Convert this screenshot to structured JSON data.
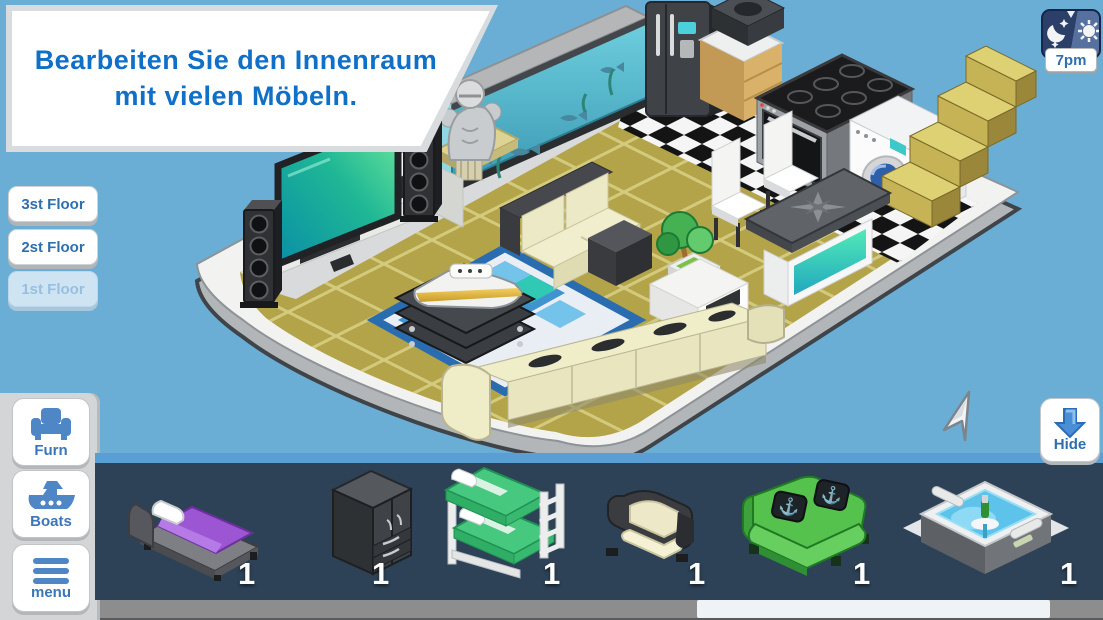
{
  "banner": {
    "text": "Bearbeiten Sie den Innenraum mit vielen Möbeln."
  },
  "floor_buttons": [
    {
      "label": "3st Floor",
      "active": true
    },
    {
      "label": "2st Floor",
      "active": true
    },
    {
      "label": "1st Floor",
      "active": false
    }
  ],
  "time_widget": {
    "label": "7pm",
    "icon": "day-night-cycle-icon"
  },
  "sidebar_buttons": [
    {
      "label": "Furn",
      "icon": "armchair-icon"
    },
    {
      "label": "Boats",
      "icon": "boat-icon"
    },
    {
      "label": "menu",
      "icon": "hamburger-menu-icon"
    }
  ],
  "hide_button": {
    "label": "Hide",
    "icon": "arrow-down-icon"
  },
  "inventory": {
    "items": [
      {
        "name": "single-bed-purple",
        "count": "1"
      },
      {
        "name": "wardrobe-black",
        "count": "1"
      },
      {
        "name": "bunk-bed-green",
        "count": "1"
      },
      {
        "name": "armchair-black-cream",
        "count": "1"
      },
      {
        "name": "sofa-green-anchor-pillows",
        "count": "1"
      },
      {
        "name": "hot-tub",
        "count": "1"
      }
    ]
  },
  "scene": {
    "objects": [
      "tv",
      "tv-stand",
      "tower-speakers",
      "statue-bust",
      "aquarium",
      "fridge",
      "kitchen-sink-counter",
      "stove-oven",
      "washing-machine",
      "stairs",
      "cream-sofa",
      "long-cream-couch",
      "dining-chairs",
      "sideboard-table-compass",
      "side-table-with-plant",
      "yacht-model-on-stack",
      "blue-rug"
    ]
  },
  "colors": {
    "sky": "#6aaed6",
    "accent_blue": "#1070c8",
    "button_text_blue": "#2e6fae",
    "panel_dark": "#2d4257",
    "panel_edge_blue": "#5b9ed3",
    "deck_white": "#f2f3f1",
    "floor_khaki": "#b3a349",
    "grout": "#d4ca7e",
    "aquarium_teal": "#54c2d6",
    "glow_teal": "#2fe0a8",
    "scroll_thumb": "#eff3f5"
  }
}
